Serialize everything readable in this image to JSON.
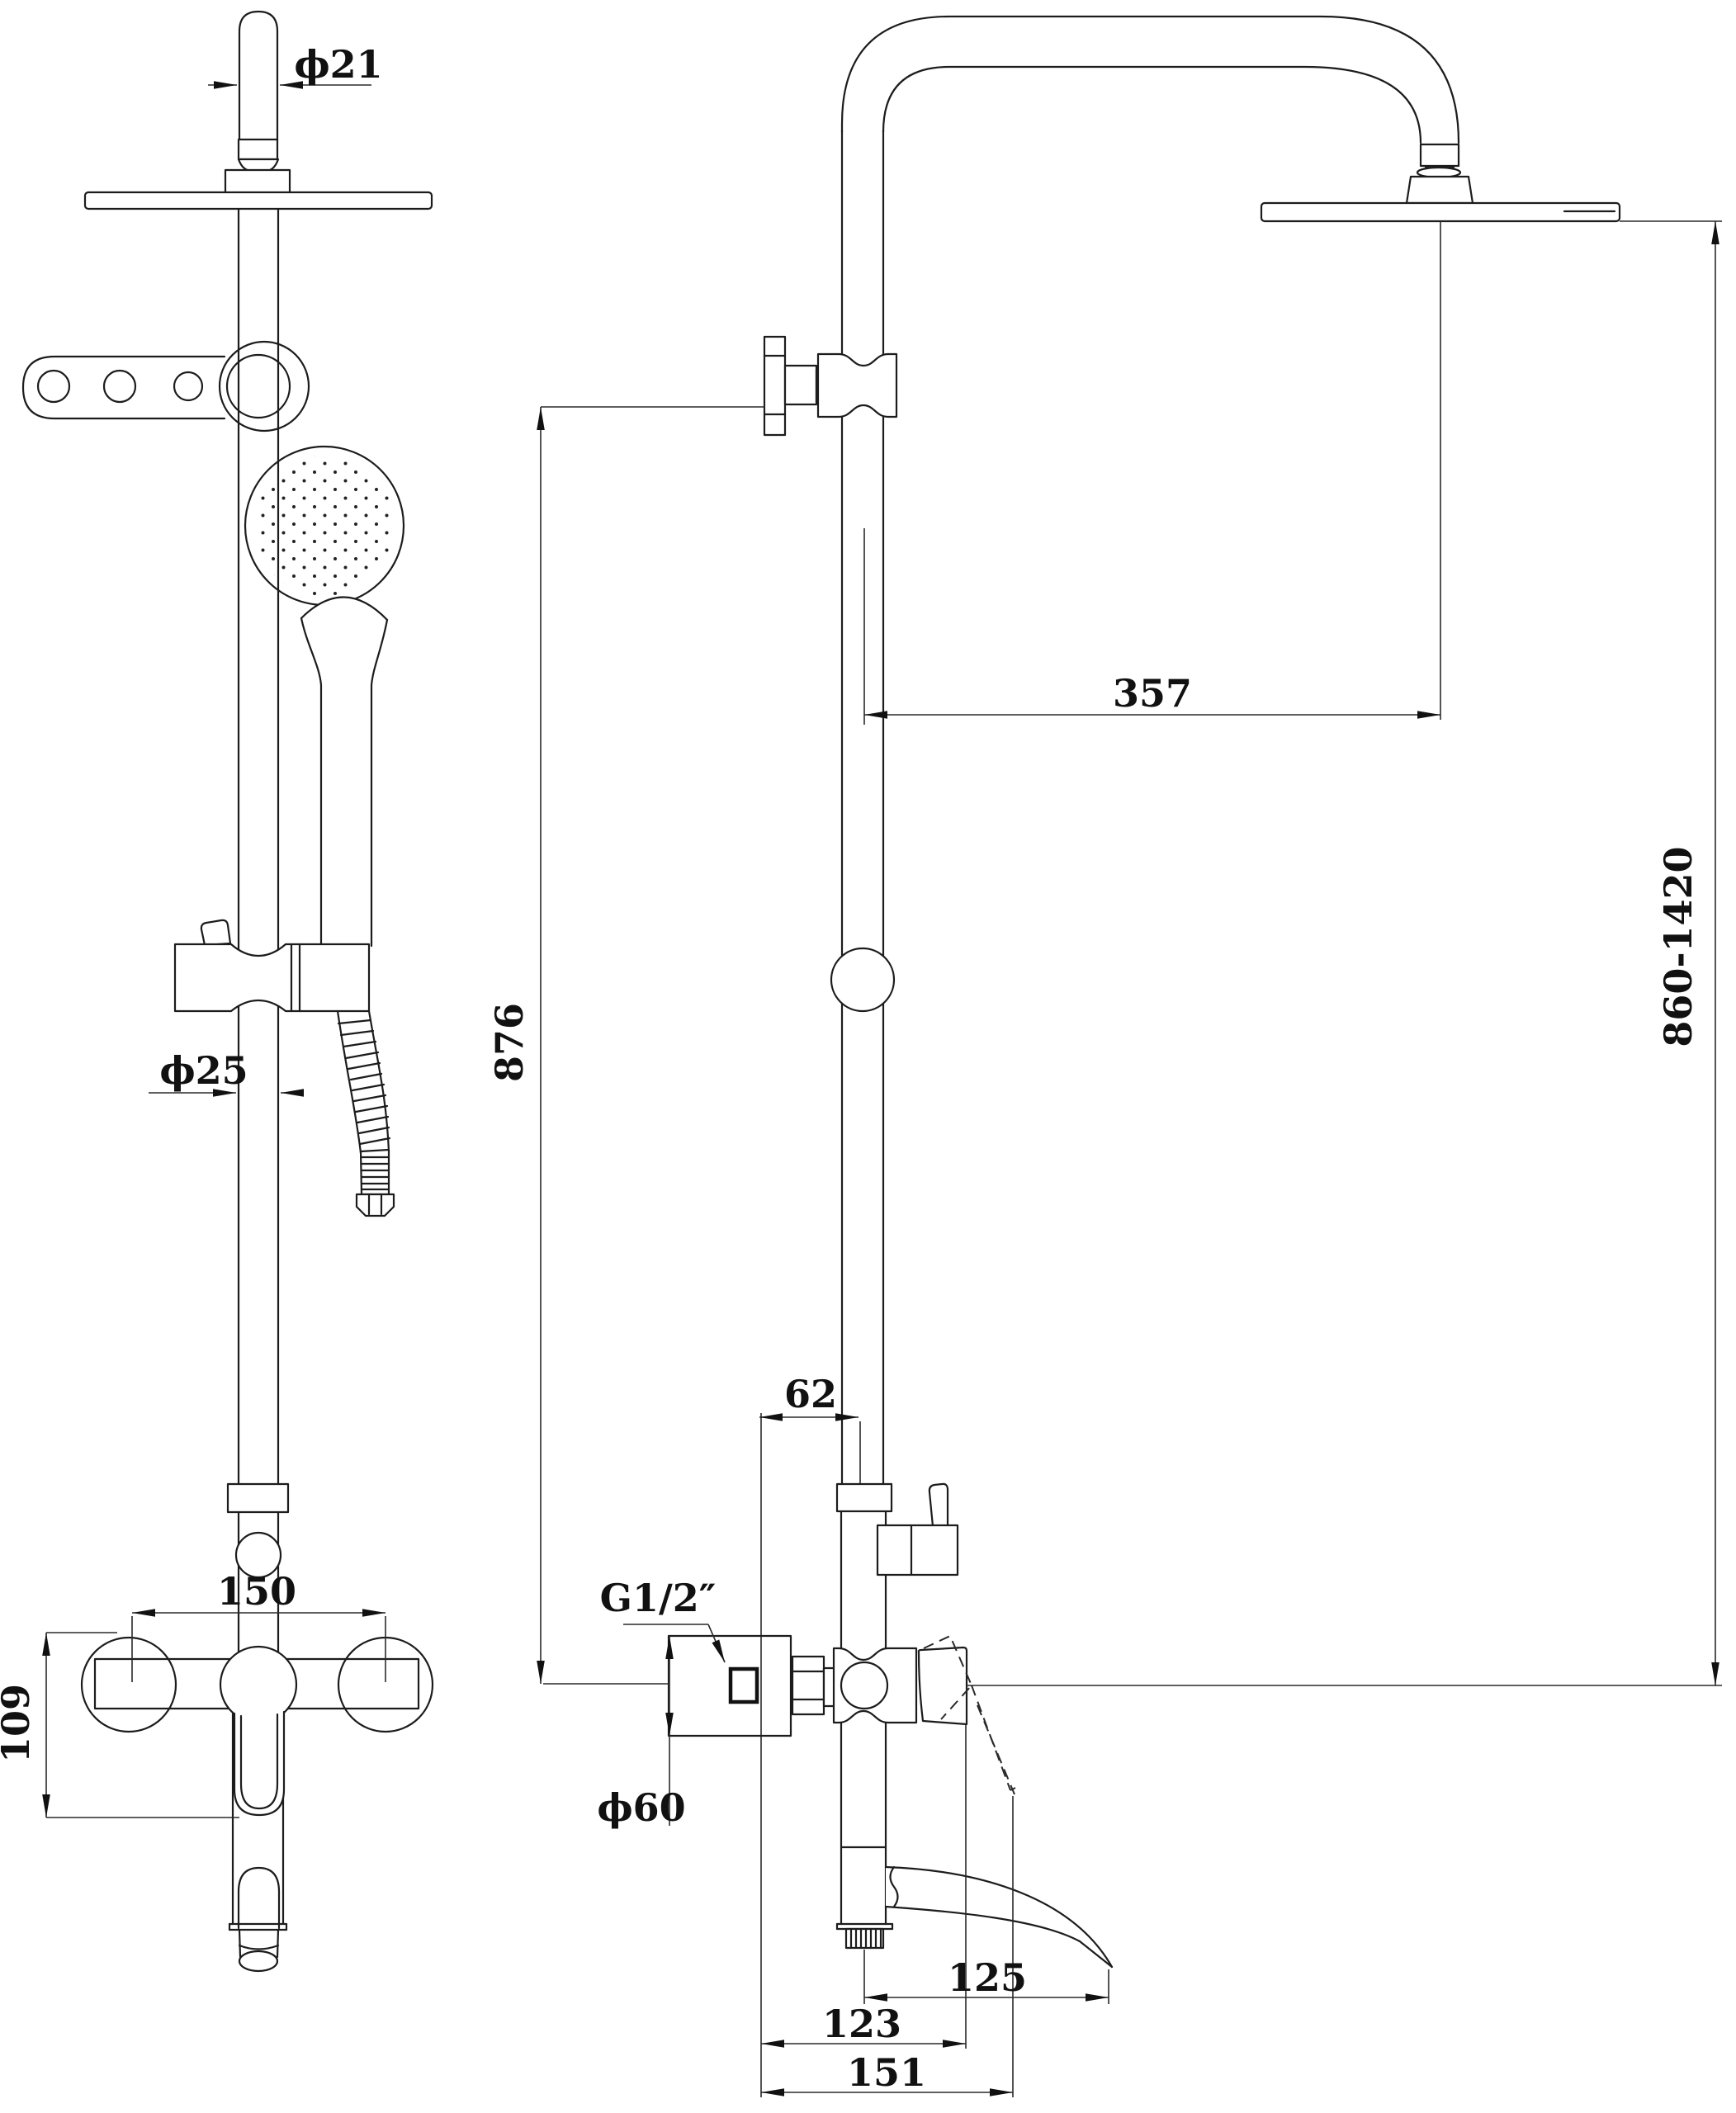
{
  "title": "shower-system-technical-drawing",
  "dimensions": {
    "head_pipe_diameter": "ϕ21",
    "head_offset_from_riser": "357",
    "wall_bracket_to_mixer_height": "876",
    "overall_height_range": "860-1420",
    "riser_diameter": "ϕ25",
    "wall_to_riser_center": "62",
    "inlet_thread": "G1/2″",
    "escutcheon_diameter": "ϕ60",
    "mixer_inlet_centers": "150",
    "mixer_body_height": "109",
    "outlet_to_spout_tip": "125",
    "wall_to_lever_closed": "123",
    "wall_to_lever_open": "151"
  }
}
